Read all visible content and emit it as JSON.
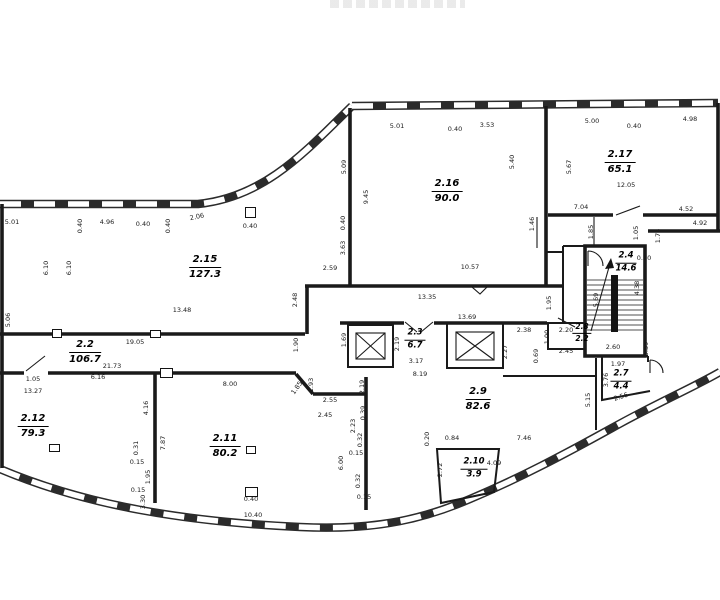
{
  "drawing": {
    "colors": {
      "line": "#1a1a1a",
      "background": "#ffffff"
    },
    "rooms": [
      {
        "number": "2.15",
        "area": "127.3",
        "x": 205,
        "y": 267,
        "size": "lg"
      },
      {
        "number": "2.16",
        "area": "90.0",
        "x": 447,
        "y": 191,
        "size": "lg"
      },
      {
        "number": "2.17",
        "area": "65.1",
        "x": 620,
        "y": 162,
        "size": "lg"
      },
      {
        "number": "2.2",
        "area": "106.7",
        "x": 85,
        "y": 352,
        "size": "lg"
      },
      {
        "number": "2.3",
        "area": "6.7",
        "x": 415,
        "y": 340,
        "size": "sm"
      },
      {
        "number": "2.4",
        "area": "14.6",
        "x": 626,
        "y": 263,
        "size": "sm"
      },
      {
        "number": "2.8",
        "area": "2.2",
        "x": 582,
        "y": 333,
        "size": "xs"
      },
      {
        "number": "2.7",
        "area": "4.4",
        "x": 621,
        "y": 381,
        "size": "sm"
      },
      {
        "number": "2.9",
        "area": "82.6",
        "x": 478,
        "y": 399,
        "size": "lg"
      },
      {
        "number": "2.10",
        "area": "3.9",
        "x": 474,
        "y": 469,
        "size": "sm"
      },
      {
        "number": "2.11",
        "area": "80.2",
        "x": 225,
        "y": 446,
        "size": "lg"
      },
      {
        "number": "2.12",
        "area": "79.3",
        "x": 33,
        "y": 426,
        "size": "lg"
      }
    ],
    "dimensions": [
      {
        "t": "5.01",
        "x": 12,
        "y": 222,
        "r": 0
      },
      {
        "t": "0.40",
        "x": 80,
        "y": 226,
        "r": -90
      },
      {
        "t": "4.96",
        "x": 107,
        "y": 222,
        "r": 0
      },
      {
        "t": "0.40",
        "x": 143,
        "y": 224,
        "r": 0
      },
      {
        "t": "0.40",
        "x": 168,
        "y": 226,
        "r": -90
      },
      {
        "t": "2.06",
        "x": 197,
        "y": 217,
        "r": -12
      },
      {
        "t": "0.40",
        "x": 250,
        "y": 226,
        "r": 0
      },
      {
        "t": "5.01",
        "x": 397,
        "y": 126,
        "r": 0
      },
      {
        "t": "0.40",
        "x": 455,
        "y": 129,
        "r": 0
      },
      {
        "t": "3.53",
        "x": 487,
        "y": 125,
        "r": 0
      },
      {
        "t": "5.00",
        "x": 592,
        "y": 121,
        "r": 0
      },
      {
        "t": "0.40",
        "x": 634,
        "y": 126,
        "r": 0
      },
      {
        "t": "4.98",
        "x": 690,
        "y": 119,
        "r": 0
      },
      {
        "t": "6.10",
        "x": 46,
        "y": 268,
        "r": -90
      },
      {
        "t": "6.10",
        "x": 69,
        "y": 268,
        "r": -90
      },
      {
        "t": "5.06",
        "x": 8,
        "y": 320,
        "r": -90
      },
      {
        "t": "5.09",
        "x": 344,
        "y": 167,
        "r": -90
      },
      {
        "t": "9.45",
        "x": 366,
        "y": 197,
        "r": -90
      },
      {
        "t": "0.40",
        "x": 343,
        "y": 223,
        "r": -90
      },
      {
        "t": "3.63",
        "x": 343,
        "y": 248,
        "r": -90
      },
      {
        "t": "5.40",
        "x": 512,
        "y": 162,
        "r": -90
      },
      {
        "t": "5.67",
        "x": 569,
        "y": 167,
        "r": -90
      },
      {
        "t": "1.46",
        "x": 532,
        "y": 224,
        "r": -90
      },
      {
        "t": "1.85",
        "x": 591,
        "y": 232,
        "r": -90
      },
      {
        "t": "12.05",
        "x": 626,
        "y": 185,
        "r": 0
      },
      {
        "t": "7.04",
        "x": 581,
        "y": 207,
        "r": 0
      },
      {
        "t": "4.52",
        "x": 686,
        "y": 209,
        "r": 0
      },
      {
        "t": "4.92",
        "x": 700,
        "y": 223,
        "r": 0
      },
      {
        "t": "1.05",
        "x": 636,
        "y": 233,
        "r": -90
      },
      {
        "t": "1.74",
        "x": 658,
        "y": 236,
        "r": -90
      },
      {
        "t": "0.70",
        "x": 644,
        "y": 258,
        "r": 0
      },
      {
        "t": "2.59",
        "x": 330,
        "y": 268,
        "r": 0
      },
      {
        "t": "10.57",
        "x": 470,
        "y": 267,
        "r": 0
      },
      {
        "t": "13.35",
        "x": 427,
        "y": 297,
        "r": 0
      },
      {
        "t": "2.48",
        "x": 295,
        "y": 300,
        "r": -90
      },
      {
        "t": "1.95",
        "x": 549,
        "y": 303,
        "r": -90
      },
      {
        "t": "13.48",
        "x": 182,
        "y": 310,
        "r": 0
      },
      {
        "t": "19.05",
        "x": 135,
        "y": 342,
        "r": 0
      },
      {
        "t": "1.90",
        "x": 296,
        "y": 345,
        "r": -90
      },
      {
        "t": "21.73",
        "x": 112,
        "y": 366,
        "r": 0
      },
      {
        "t": "1.05",
        "x": 33,
        "y": 379,
        "r": 0
      },
      {
        "t": "6.16",
        "x": 98,
        "y": 377,
        "r": 0
      },
      {
        "t": "13.27",
        "x": 33,
        "y": 391,
        "r": 0
      },
      {
        "t": "4.16",
        "x": 146,
        "y": 408,
        "r": -90
      },
      {
        "t": "13.69",
        "x": 467,
        "y": 317,
        "r": 0
      },
      {
        "t": "1.69",
        "x": 344,
        "y": 340,
        "r": -90
      },
      {
        "t": "2.19",
        "x": 397,
        "y": 344,
        "r": -90
      },
      {
        "t": "3.17",
        "x": 416,
        "y": 361,
        "r": 0
      },
      {
        "t": "8.19",
        "x": 420,
        "y": 374,
        "r": 0
      },
      {
        "t": "2.27",
        "x": 505,
        "y": 352,
        "r": -90
      },
      {
        "t": "2.38",
        "x": 524,
        "y": 330,
        "r": 0
      },
      {
        "t": "1.00",
        "x": 547,
        "y": 337,
        "r": -90
      },
      {
        "t": "0.69",
        "x": 536,
        "y": 356,
        "r": -90
      },
      {
        "t": "2.20",
        "x": 566,
        "y": 330,
        "r": 0
      },
      {
        "t": "2.45",
        "x": 566,
        "y": 351,
        "r": 0
      },
      {
        "t": "2.60",
        "x": 613,
        "y": 347,
        "r": 0
      },
      {
        "t": "5.69",
        "x": 596,
        "y": 300,
        "r": -90
      },
      {
        "t": "4.38",
        "x": 637,
        "y": 288,
        "r": -90
      },
      {
        "t": "0.39",
        "x": 646,
        "y": 349,
        "r": -90
      },
      {
        "t": "1.97",
        "x": 618,
        "y": 364,
        "r": 0
      },
      {
        "t": "3.76",
        "x": 606,
        "y": 380,
        "r": -90
      },
      {
        "t": "2.56",
        "x": 621,
        "y": 397,
        "r": -18
      },
      {
        "t": "5.15",
        "x": 588,
        "y": 400,
        "r": -90
      },
      {
        "t": "0.20",
        "x": 427,
        "y": 439,
        "r": -90
      },
      {
        "t": "0.84",
        "x": 452,
        "y": 438,
        "r": 0
      },
      {
        "t": "7.46",
        "x": 524,
        "y": 438,
        "r": 0
      },
      {
        "t": "2.72",
        "x": 440,
        "y": 470,
        "r": -90
      },
      {
        "t": "4.09",
        "x": 494,
        "y": 463,
        "r": 0
      },
      {
        "t": "1.93",
        "x": 311,
        "y": 385,
        "r": -90
      },
      {
        "t": "1.85",
        "x": 297,
        "y": 388,
        "r": -55
      },
      {
        "t": "2.55",
        "x": 330,
        "y": 400,
        "r": 0
      },
      {
        "t": "2.45",
        "x": 325,
        "y": 415,
        "r": 0
      },
      {
        "t": "2.19",
        "x": 362,
        "y": 387,
        "r": -90
      },
      {
        "t": "0.39",
        "x": 363,
        "y": 413,
        "r": -90
      },
      {
        "t": "2.23",
        "x": 353,
        "y": 426,
        "r": -90
      },
      {
        "t": "0.32",
        "x": 360,
        "y": 440,
        "r": -90
      },
      {
        "t": "0.15",
        "x": 356,
        "y": 453,
        "r": 0
      },
      {
        "t": "6.00",
        "x": 341,
        "y": 463,
        "r": -90
      },
      {
        "t": "0.32",
        "x": 358,
        "y": 481,
        "r": -90
      },
      {
        "t": "0.15",
        "x": 364,
        "y": 497,
        "r": 0
      },
      {
        "t": "8.00",
        "x": 230,
        "y": 384,
        "r": 0
      },
      {
        "t": "7.87",
        "x": 163,
        "y": 443,
        "r": -90
      },
      {
        "t": "0.31",
        "x": 136,
        "y": 448,
        "r": -90
      },
      {
        "t": "0.15",
        "x": 137,
        "y": 462,
        "r": 0
      },
      {
        "t": "1.95",
        "x": 148,
        "y": 477,
        "r": -90
      },
      {
        "t": "0.15",
        "x": 138,
        "y": 490,
        "r": 0
      },
      {
        "t": "3.30",
        "x": 143,
        "y": 502,
        "r": -90
      },
      {
        "t": "0.40",
        "x": 251,
        "y": 499,
        "r": 0
      },
      {
        "t": "10.40",
        "x": 253,
        "y": 515,
        "r": 0
      }
    ],
    "columns": [
      {
        "x": 245,
        "y": 207,
        "w": 11,
        "h": 11
      },
      {
        "x": 49,
        "y": 444,
        "w": 11,
        "h": 8
      },
      {
        "x": 246,
        "y": 446,
        "w": 10,
        "h": 8
      },
      {
        "x": 245,
        "y": 487,
        "w": 13,
        "h": 10
      },
      {
        "x": 160,
        "y": 368,
        "w": 13,
        "h": 10
      },
      {
        "x": 52,
        "y": 329,
        "w": 10,
        "h": 9
      },
      {
        "x": 150,
        "y": 330,
        "w": 11,
        "h": 8
      }
    ]
  }
}
